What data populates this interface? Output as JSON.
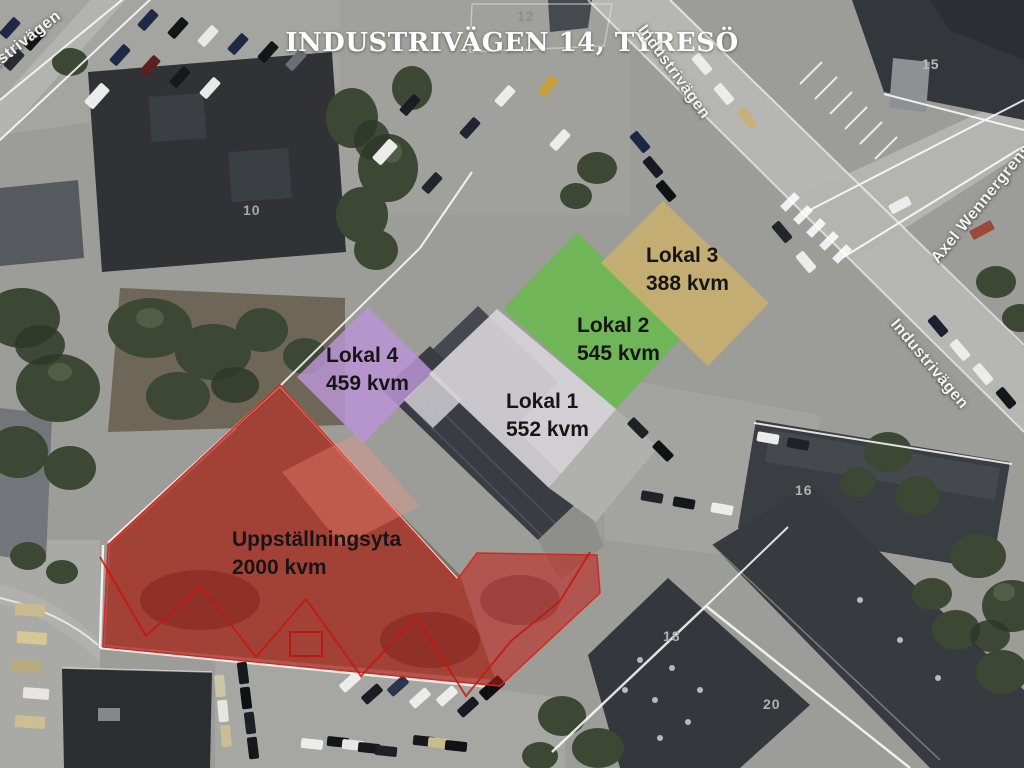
{
  "title": "INDUSTRIVÄGEN 14, TYRESÖ",
  "areas": {
    "lokal4": {
      "name": "Lokal 4",
      "size": "459 kvm",
      "color": "#ba94d3"
    },
    "lokal1": {
      "name": "Lokal 1",
      "size": "552 kvm",
      "color": "#d8d5da"
    },
    "lokal2": {
      "name": "Lokal 2",
      "size": "545 kvm",
      "color": "#68bb4c"
    },
    "lokal3": {
      "name": "Lokal 3",
      "size": "388 kvm",
      "color": "#c9af6d"
    },
    "uppstallningsyta": {
      "name": "Uppställningsyta",
      "size": "2000 kvm",
      "color": "#c11c14"
    }
  },
  "streets": {
    "industrivagen_topleft": "Industrivägen",
    "industrivagen_top": "Industrivägen",
    "industrivagen_right": "Industrivägen",
    "axel_wennergrens": "Axel Wennergrens väg"
  },
  "lot_numbers": {
    "n12": "12",
    "n10": "10",
    "n15": "15",
    "n16": "16",
    "n18": "18",
    "n20": "20"
  }
}
